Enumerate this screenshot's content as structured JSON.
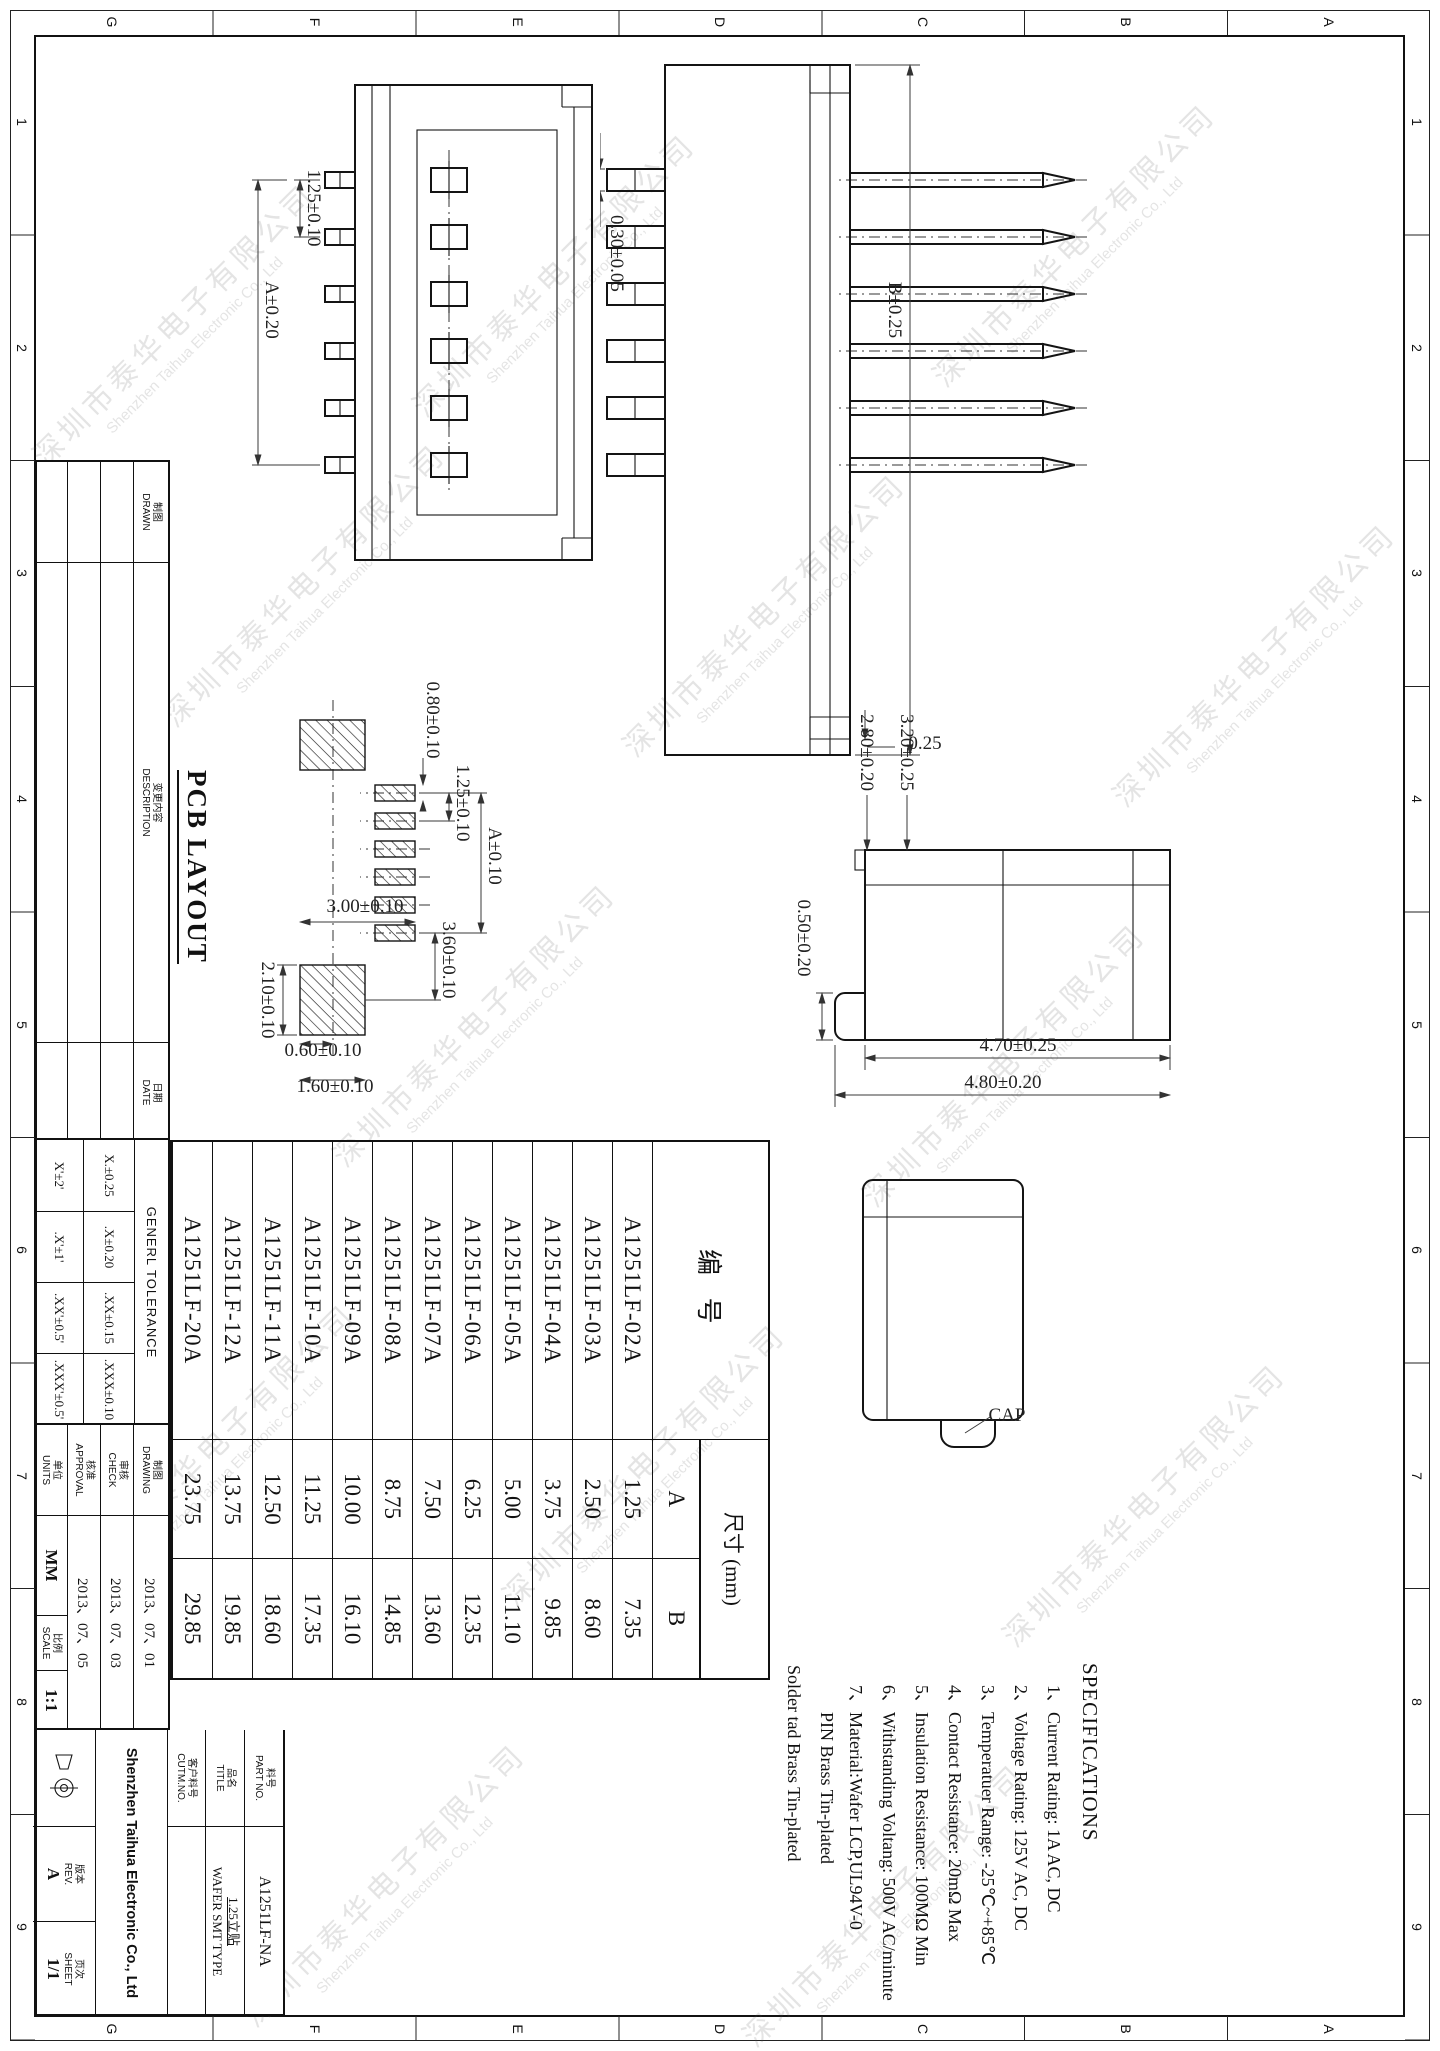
{
  "watermark": {
    "cn": "深圳市泰华电子有限公司",
    "en": "Shenzhen Taihua Electronic Co., Ltd"
  },
  "frame": {
    "letters": [
      "A",
      "B",
      "C",
      "D",
      "E",
      "F",
      "G"
    ],
    "numbers": [
      "1",
      "2",
      "3",
      "4",
      "5",
      "6",
      "7",
      "8",
      "9"
    ]
  },
  "views": {
    "v1_pitch": "1.25±0.10",
    "v1_span": "A±0.20",
    "v2_width": "B±0.25",
    "v2_pin": "0.30±0.05",
    "v2_wall": "0.25",
    "v3_top": "3.20±0.25",
    "v3_mid": "2.80±0.20",
    "v3_foot": "0.50±0.20",
    "v3_body": "4.70±0.25",
    "v3_overall": "4.80±0.20",
    "v4_cap": "CAP"
  },
  "pcb": {
    "title": "PCB LAYOUT",
    "span": "A±0.10",
    "pitch": "1.25±0.10",
    "pad_w": "0.80±0.10",
    "gap": "3.60±0.10",
    "big_w": "3.00±0.10",
    "big_h": "2.10±0.10",
    "off_a": "0.60±0.10",
    "off_b": "1.60±0.10"
  },
  "specs": {
    "title": "SPECIFICATIONS",
    "items": [
      "1、Current Rating: 1A AC, DC",
      "2、Voltage Rating: 125V AC, DC",
      "3、Temperatuer Range: -25℃~+85℃",
      "4、Contact Resistance: 20mΩ Max",
      "5、Insulation Resistance: 100MΩ Min",
      "6、Withstanding Voltang: 500V AC/minute",
      "7、Material:Wafer LCP,UL94V-0",
      "PIN Brass Tin-plated",
      "Solder tad Brass Tin-plated"
    ]
  },
  "table": {
    "h_part": "编  号",
    "h_dim": "尺寸 (mm)",
    "h_a": "A",
    "h_b": "B",
    "rows": [
      {
        "part": "A1251LF-02A",
        "a": "1.25",
        "b": "7.35"
      },
      {
        "part": "A1251LF-03A",
        "a": "2.50",
        "b": "8.60"
      },
      {
        "part": "A1251LF-04A",
        "a": "3.75",
        "b": "9.85"
      },
      {
        "part": "A1251LF-05A",
        "a": "5.00",
        "b": "11.10"
      },
      {
        "part": "A1251LF-06A",
        "a": "6.25",
        "b": "12.35"
      },
      {
        "part": "A1251LF-07A",
        "a": "7.50",
        "b": "13.60"
      },
      {
        "part": "A1251LF-08A",
        "a": "8.75",
        "b": "14.85"
      },
      {
        "part": "A1251LF-09A",
        "a": "10.00",
        "b": "16.10"
      },
      {
        "part": "A1251LF-10A",
        "a": "11.25",
        "b": "17.35"
      },
      {
        "part": "A1251LF-11A",
        "a": "12.50",
        "b": "18.60"
      },
      {
        "part": "A1251LF-12A",
        "a": "13.75",
        "b": "19.85"
      },
      {
        "part": "A1251LF-20A",
        "a": "23.75",
        "b": "29.85"
      }
    ]
  },
  "tb": {
    "drawn": "DRAWN",
    "drawn_cn": "制图",
    "desc": "DESCRIPTION",
    "desc_cn": "变更内容",
    "date": "DATE",
    "date_cn": "日期",
    "tol_title": "GENERL TOLERANCE",
    "tol": [
      "X.±0.25",
      ".X±0.20",
      ".XX±0.15",
      ".XXX±0.10"
    ],
    "tol_deg": [
      "X'±2'",
      ".X'±1'",
      ".XX'±0.5'",
      ".XXX'±0.5'"
    ],
    "drawing": "DRAWING",
    "drawing_cn": "制图",
    "drawing_date": "2013、07、01",
    "check": "CHECK",
    "check_cn": "审核",
    "check_date": "2013、07、03",
    "approval": "APPROVAL",
    "approval_cn": "核准",
    "approval_date": "2013、07、05",
    "units": "UNITS",
    "units_cn": "单位",
    "units_val": "MM",
    "scale": "SCALE",
    "scale_cn": "比例",
    "scale_val": "1:1",
    "partno": "PART NO.",
    "partno_cn": "料号",
    "partno_val": "A1251LF-NA",
    "title": "TITLE",
    "title_cn": "品名",
    "title_val1": "1.25立贴",
    "title_val2": "WAFER SMT TYPE",
    "cutm": "CUTM.NO.",
    "cutm_cn": "客户料号",
    "rev": "REV.",
    "rev_cn": "版本",
    "rev_val": "A",
    "sheet": "SHEET",
    "sheet_cn": "页次",
    "sheet_val": "1/1",
    "company": "Shenzhen Taihua Electronic Co., Ltd"
  }
}
